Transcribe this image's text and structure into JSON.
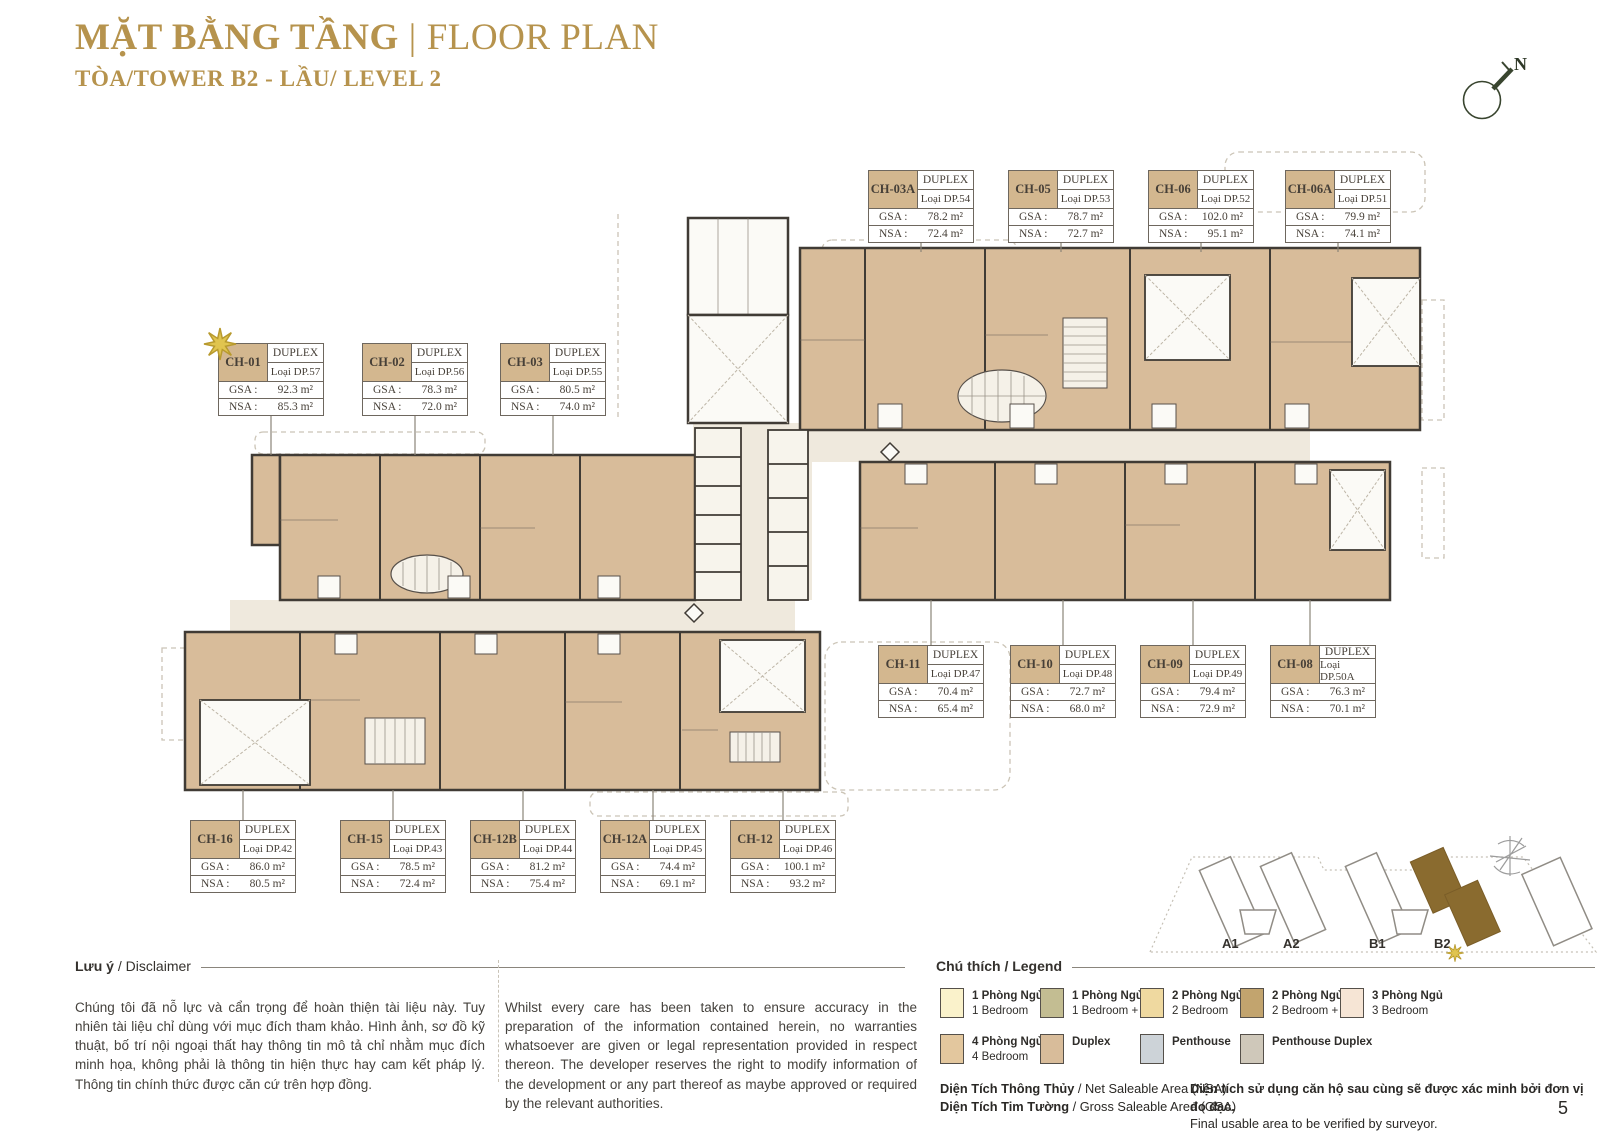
{
  "page": {
    "title_vi": "MẶT BẰNG TẦNG",
    "title_divider": "|",
    "title_en": "FLOOR PLAN",
    "subtitle": "TÒA/TOWER B2 - LẦU/ LEVEL 2",
    "page_number": "5"
  },
  "compass": {
    "label": "N"
  },
  "icons": {
    "north_compass": "circle-with-needle-pointing-NE",
    "unit_highlight_star": "8-point-gold-star",
    "locator_star": "8-point-gold-star",
    "site_compass_decoration": "gray-sketch-compass"
  },
  "colors": {
    "accent_gold": "#b6934d",
    "unit_fill_tan": "#d8bc9a",
    "wall_dark": "#403b35",
    "corridor": "#efe9dd",
    "box_header_tan": "#d3b78f",
    "locator_highlight_brown": "#8a6b2f",
    "star_gold": "#e0c44f"
  },
  "labels": {
    "gsa": "GSA :",
    "nsa": "NSA :"
  },
  "units": [
    {
      "code": "CH-01",
      "type": "DUPLEX",
      "variant": "Loại DP.57",
      "gsa": "92.3 m²",
      "nsa": "85.3 m²"
    },
    {
      "code": "CH-02",
      "type": "DUPLEX",
      "variant": "Loại DP.56",
      "gsa": "78.3 m²",
      "nsa": "72.0 m²"
    },
    {
      "code": "CH-03",
      "type": "DUPLEX",
      "variant": "Loại DP.55",
      "gsa": "80.5 m²",
      "nsa": "74.0 m²"
    },
    {
      "code": "CH-03A",
      "type": "DUPLEX",
      "variant": "Loại DP.54",
      "gsa": "78.2 m²",
      "nsa": "72.4 m²"
    },
    {
      "code": "CH-05",
      "type": "DUPLEX",
      "variant": "Loại DP.53",
      "gsa": "78.7 m²",
      "nsa": "72.7 m²"
    },
    {
      "code": "CH-06",
      "type": "DUPLEX",
      "variant": "Loại DP.52",
      "gsa": "102.0 m²",
      "nsa": "95.1 m²"
    },
    {
      "code": "CH-06A",
      "type": "DUPLEX",
      "variant": "Loại DP.51",
      "gsa": "79.9 m²",
      "nsa": "74.1 m²"
    },
    {
      "code": "CH-08",
      "type": "DUPLEX",
      "variant": "Loại DP.50A",
      "gsa": "76.3 m²",
      "nsa": "70.1 m²"
    },
    {
      "code": "CH-09",
      "type": "DUPLEX",
      "variant": "Loại DP.49",
      "gsa": "79.4 m²",
      "nsa": "72.9 m²"
    },
    {
      "code": "CH-10",
      "type": "DUPLEX",
      "variant": "Loại DP.48",
      "gsa": "72.7 m²",
      "nsa": "68.0 m²"
    },
    {
      "code": "CH-11",
      "type": "DUPLEX",
      "variant": "Loại DP.47",
      "gsa": "70.4 m²",
      "nsa": "65.4 m²"
    },
    {
      "code": "CH-12",
      "type": "DUPLEX",
      "variant": "Loại DP.46",
      "gsa": "100.1 m²",
      "nsa": "93.2 m²"
    },
    {
      "code": "CH-12A",
      "type": "DUPLEX",
      "variant": "Loại DP.45",
      "gsa": "74.4 m²",
      "nsa": "69.1 m²"
    },
    {
      "code": "CH-12B",
      "type": "DUPLEX",
      "variant": "Loại DP.44",
      "gsa": "81.2 m²",
      "nsa": "75.4 m²"
    },
    {
      "code": "CH-15",
      "type": "DUPLEX",
      "variant": "Loại DP.43",
      "gsa": "78.5 m²",
      "nsa": "72.4 m²"
    },
    {
      "code": "CH-16",
      "type": "DUPLEX",
      "variant": "Loại DP.42",
      "gsa": "86.0 m²",
      "nsa": "80.5 m²"
    }
  ],
  "disclaimer": {
    "heading_bold": "Lưu ý",
    "heading_rest": "/ Disclaimer",
    "text_vi": "Chúng tôi đã nỗ lực và cẩn trọng để hoàn thiện tài liệu này. Tuy nhiên tài liệu chỉ dùng với mục đích tham khảo. Hình ảnh, sơ đồ kỹ thuật, bố trí nội ngoại thất hay thông tin mô tả chỉ nhằm mục đích minh họa, không phải là thông tin hiện thực hay cam kết pháp lý. Thông tin chính thức được căn cứ trên hợp đồng.",
    "text_en": "Whilst every care has been taken to ensure accuracy in the preparation of the information contained herein, no warranties whatsoever are given or legal representation provided in respect thereon. The developer reserves the right to modify information of the development or any part thereof as maybe approved or required by the relevant authorities."
  },
  "legend": {
    "heading_bold": "Chú thích",
    "heading_rest": "/ Legend",
    "items": [
      {
        "vi": "1 Phòng Ngủ",
        "en": "1 Bedroom",
        "color": "#faf2cb"
      },
      {
        "vi": "1 Phòng Ngủ +",
        "en": "1 Bedroom +",
        "color": "#c3bd92"
      },
      {
        "vi": "2 Phòng Ngủ",
        "en": "2 Bedroom",
        "color": "#efd9a0"
      },
      {
        "vi": "2 Phòng Ngủ +",
        "en": "2 Bedroom +",
        "color": "#c2a46e"
      },
      {
        "vi": "3 Phòng Ngủ",
        "en": "3 Bedroom",
        "color": "#f6e5d5"
      },
      {
        "vi": "4 Phòng Ngủ",
        "en": "4 Bedroom",
        "color": "#e3c79e"
      },
      {
        "vi": "Duplex",
        "en": "",
        "color": "#d8bc9a"
      },
      {
        "vi": "Penthouse",
        "en": "",
        "color": "#cdd3d8"
      },
      {
        "vi": "Penthouse Duplex",
        "en": "",
        "color": "#cfc8ba"
      }
    ],
    "nsa_bold": "Diện Tích Thông Thủy",
    "nsa_rest": "/ Net Saleable Area (NSA)",
    "gsa_bold": "Diện Tích Tim Tường",
    "gsa_rest": "/ Gross Saleable Area (GSA)",
    "note_vi": "Diện tích sử dụng căn hộ sau cùng sẽ được xác minh bởi đơn vị đo đạc.",
    "note_en": "Final usable area to be verified by surveyor."
  },
  "locator": {
    "towers": [
      "A1",
      "A2",
      "B1",
      "B2"
    ],
    "highlighted": "B2"
  }
}
